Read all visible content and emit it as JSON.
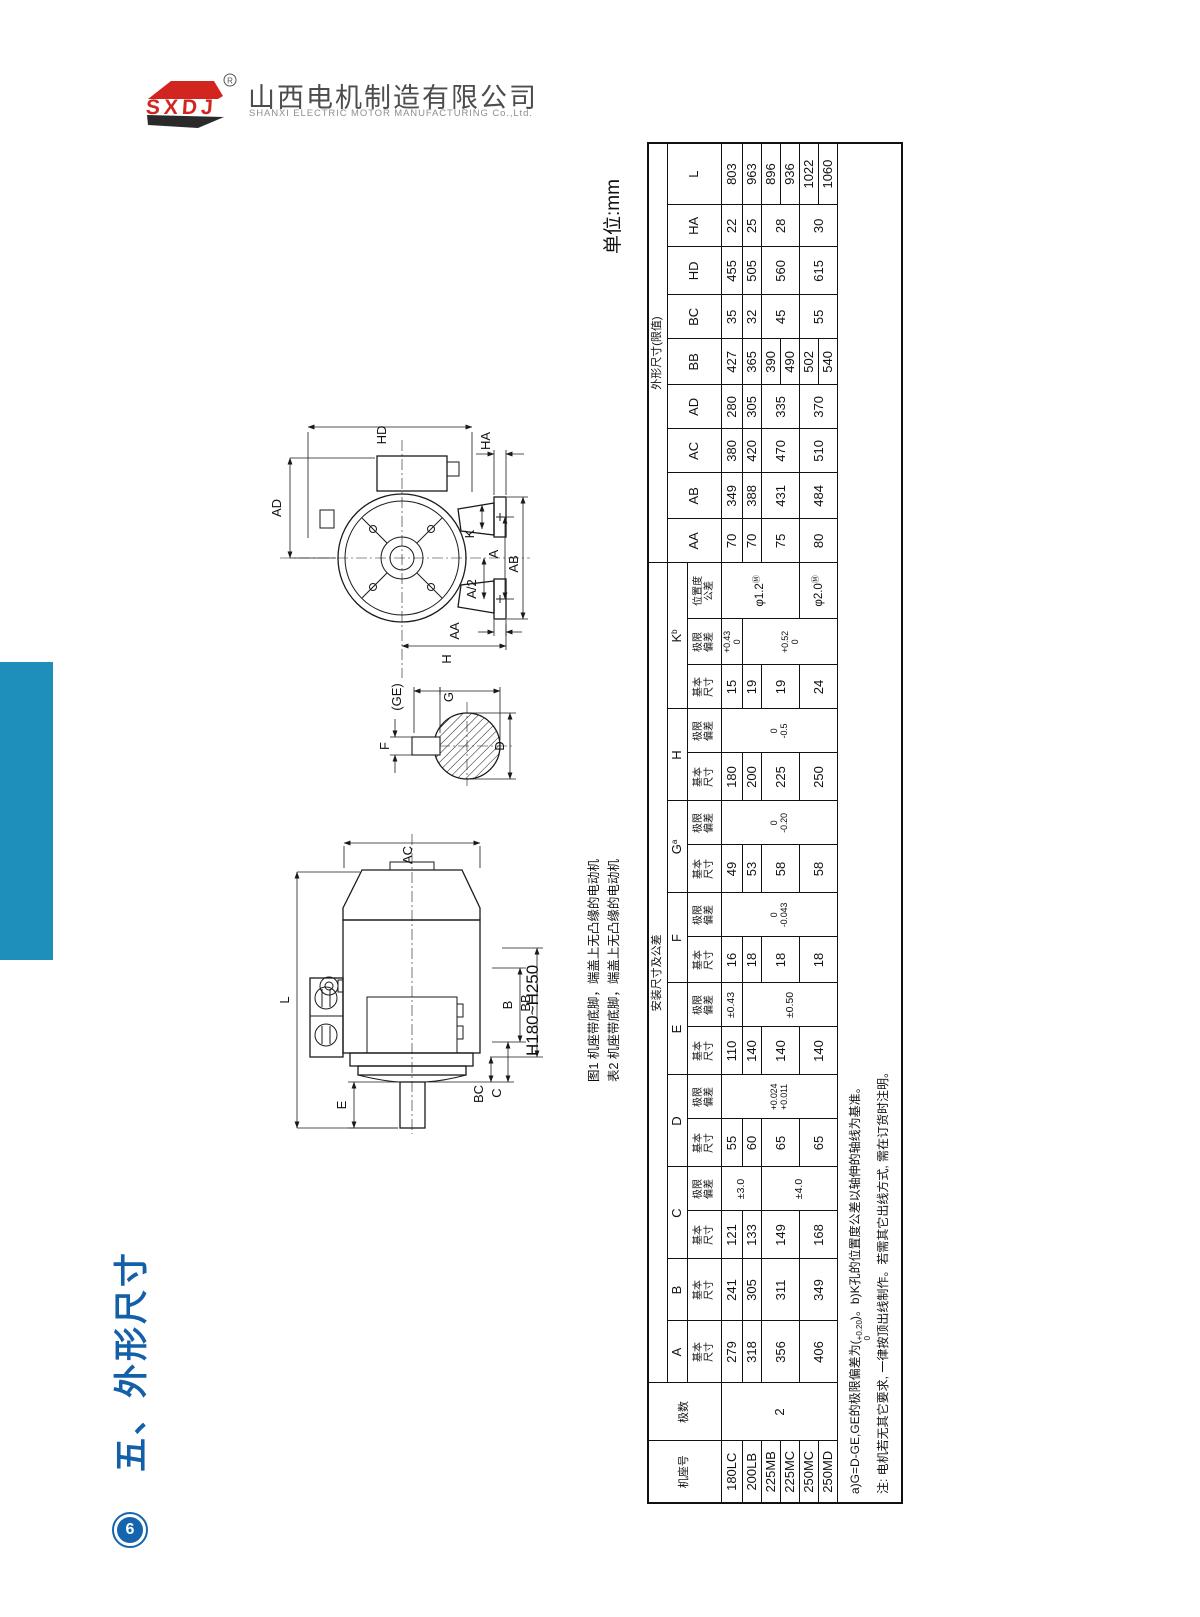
{
  "colors": {
    "bar_blue": "#1d8fba",
    "title_blue": "#135fa8",
    "logo_red": "#d3251f",
    "line_black": "#1a1a1a"
  },
  "logo": {
    "brand": "SXDJ",
    "reg_mark": "R",
    "company_cn": "山西电机制造有限公司",
    "company_en": "SHANXI ELECTRIC MOTOR MANUFACTURING Co.,Ltd."
  },
  "page": {
    "section_title": "五、外形尺寸",
    "unit_label": "单位:mm",
    "page_number": "6",
    "frame_range_label": "H180~H250",
    "caption_fig1": "图1 机座带底脚，端盖上无凸缘的电动机",
    "caption_tab2": "表2 机座带底脚，端盖上无凸缘的电动机"
  },
  "figure_end_view": {
    "labels": [
      {
        "t": "HD",
        "x": 124,
        "y": 47
      },
      {
        "t": "AD",
        "x": 19,
        "y": 120
      },
      {
        "t": "HA",
        "x": 228,
        "y": 53
      },
      {
        "t": "K",
        "x": 212,
        "y": 146
      },
      {
        "t": "A",
        "x": 236,
        "y": 166
      },
      {
        "t": "AB",
        "x": 256,
        "y": 176
      },
      {
        "t": "A/2",
        "x": 214,
        "y": 201
      },
      {
        "t": "AA",
        "x": 197,
        "y": 243
      },
      {
        "t": "H",
        "x": 189,
        "y": 271
      },
      {
        "t": "(GE)",
        "x": 139,
        "y": 309
      },
      {
        "t": "G",
        "x": 191,
        "y": 309
      },
      {
        "t": "F",
        "x": 127,
        "y": 358
      },
      {
        "t": "D",
        "x": 242,
        "y": 358
      }
    ]
  },
  "figure_side_view": {
    "labels": [
      {
        "t": "AC",
        "x": 150,
        "y": 27
      },
      {
        "t": "L",
        "x": 27,
        "y": 172
      },
      {
        "t": "B",
        "x": 250,
        "y": 177
      },
      {
        "t": "BB",
        "x": 268,
        "y": 175
      },
      {
        "t": "C",
        "x": 239,
        "y": 265
      },
      {
        "t": "BC",
        "x": 221,
        "y": 266
      },
      {
        "t": "E",
        "x": 84,
        "y": 277
      }
    ]
  },
  "table": {
    "col_widths": [
      62,
      58,
      62,
      62,
      48,
      44,
      48,
      44,
      48,
      44,
      46,
      44,
      48,
      44,
      48,
      44,
      44,
      46,
      56,
      44,
      46,
      44,
      44,
      46,
      44,
      48,
      42,
      62
    ],
    "header_rows": [
      [
        {
          "t": "机座号",
          "rs": 3,
          "cls": "grp"
        },
        {
          "t": "极数",
          "rs": 3,
          "cls": "grp"
        },
        {
          "t": "安装尺寸及公差",
          "cs": 17,
          "cls": "grp"
        },
        {
          "t": "外形尺寸(限值)",
          "cs": 9,
          "cls": "grp"
        }
      ],
      [
        {
          "t": "A"
        },
        {
          "t": "B"
        },
        {
          "t": "C",
          "cs": 2
        },
        {
          "t": "D",
          "cs": 2
        },
        {
          "t": "E",
          "cs": 2
        },
        {
          "t": "F",
          "cs": 2
        },
        {
          "t": "G",
          "sup": "a",
          "cs": 2
        },
        {
          "t": "H",
          "cs": 2
        },
        {
          "t": "K",
          "sup": "b",
          "cs": 3
        },
        {
          "t": "AA",
          "rs": 2
        },
        {
          "t": "AB",
          "rs": 2
        },
        {
          "t": "AC",
          "rs": 2
        },
        {
          "t": "AD",
          "rs": 2
        },
        {
          "t": "BB",
          "rs": 2
        },
        {
          "t": "BC",
          "rs": 2
        },
        {
          "t": "HD",
          "rs": 2
        },
        {
          "t": "HA",
          "rs": 2
        },
        {
          "t": "L",
          "rs": 2
        }
      ],
      [
        {
          "l": [
            "基本",
            "尺寸"
          ]
        },
        {
          "l": [
            "基本",
            "尺寸"
          ]
        },
        {
          "l": [
            "基本",
            "尺寸"
          ]
        },
        {
          "l": [
            "极限",
            "偏差"
          ]
        },
        {
          "l": [
            "基本",
            "尺寸"
          ]
        },
        {
          "l": [
            "极限",
            "偏差"
          ]
        },
        {
          "l": [
            "基本",
            "尺寸"
          ]
        },
        {
          "l": [
            "极限",
            "偏差"
          ]
        },
        {
          "l": [
            "基本",
            "尺寸"
          ]
        },
        {
          "l": [
            "极限",
            "偏差"
          ]
        },
        {
          "l": [
            "基本",
            "尺寸"
          ]
        },
        {
          "l": [
            "极限",
            "偏差"
          ]
        },
        {
          "l": [
            "基本",
            "尺寸"
          ]
        },
        {
          "l": [
            "极限",
            "偏差"
          ]
        },
        {
          "l": [
            "基本",
            "尺寸"
          ]
        },
        {
          "l": [
            "极限",
            "偏差"
          ]
        },
        {
          "l": [
            "位置度",
            "公差"
          ]
        }
      ]
    ],
    "body_rows": [
      [
        {
          "t": "180LC"
        },
        {
          "t": "2",
          "rs": 6
        },
        {
          "t": "279"
        },
        {
          "t": "241"
        },
        {
          "t": "121"
        },
        {
          "t": "±3.0",
          "rs": 2,
          "cls": "tol"
        },
        {
          "t": "55"
        },
        {
          "l": [
            "+0.024",
            "+0.011"
          ],
          "rs": 6,
          "cls": "dev"
        },
        {
          "t": "110"
        },
        {
          "t": "±0.43",
          "cls": "tol"
        },
        {
          "t": "16"
        },
        {
          "l": [
            "0",
            "-0.043"
          ],
          "rs": 6,
          "cls": "dev"
        },
        {
          "t": "49"
        },
        {
          "l": [
            "0",
            "-0.20"
          ],
          "rs": 6,
          "cls": "dev"
        },
        {
          "t": "180"
        },
        {
          "l": [
            "0",
            "-0.5"
          ],
          "rs": 6,
          "cls": "dev"
        },
        {
          "t": "15"
        },
        {
          "l": [
            "+0.43",
            "0"
          ],
          "cls": "dev"
        },
        {
          "t": "φ1.2",
          "sup": "Ⓜ",
          "rs": 4,
          "cls": "pos"
        },
        {
          "t": "70"
        },
        {
          "t": "349"
        },
        {
          "t": "380"
        },
        {
          "t": "280"
        },
        {
          "t": "427"
        },
        {
          "t": "35"
        },
        {
          "t": "455"
        },
        {
          "t": "22"
        },
        {
          "t": "803"
        }
      ],
      [
        {
          "t": "200LB"
        },
        {
          "t": "318"
        },
        {
          "t": "305"
        },
        {
          "t": "133"
        },
        {
          "t": "60"
        },
        {
          "t": "140"
        },
        {
          "t": "±0.50",
          "rs": 5,
          "cls": "tol"
        },
        {
          "t": "18"
        },
        {
          "t": "53"
        },
        {
          "t": "200"
        },
        {
          "t": "19"
        },
        {
          "l": [
            "+0.52",
            "0"
          ],
          "rs": 5,
          "cls": "dev"
        },
        {
          "t": "70"
        },
        {
          "t": "388"
        },
        {
          "t": "420"
        },
        {
          "t": "305"
        },
        {
          "t": "365"
        },
        {
          "t": "32"
        },
        {
          "t": "505"
        },
        {
          "t": "25"
        },
        {
          "t": "963"
        }
      ],
      [
        {
          "t": "225MB"
        },
        {
          "t": "356",
          "rs": 2
        },
        {
          "t": "311",
          "rs": 2
        },
        {
          "t": "149",
          "rs": 2
        },
        {
          "t": "±4.0",
          "rs": 4,
          "cls": "tol"
        },
        {
          "t": "65",
          "rs": 2
        },
        {
          "t": "140",
          "rs": 2
        },
        {
          "t": "18",
          "rs": 2
        },
        {
          "t": "58",
          "rs": 2
        },
        {
          "t": "225",
          "rs": 2
        },
        {
          "t": "19",
          "rs": 2
        },
        {
          "t": "75",
          "rs": 2
        },
        {
          "t": "431",
          "rs": 2
        },
        {
          "t": "470",
          "rs": 2
        },
        {
          "t": "335",
          "rs": 2
        },
        {
          "t": "390"
        },
        {
          "t": "45",
          "rs": 2
        },
        {
          "t": "560",
          "rs": 2
        },
        {
          "t": "28",
          "rs": 2
        },
        {
          "t": "896"
        }
      ],
      [
        {
          "t": "225MC"
        },
        {
          "t": "490"
        },
        {
          "t": "936"
        }
      ],
      [
        {
          "t": "250MC"
        },
        {
          "t": "406",
          "rs": 2
        },
        {
          "t": "349",
          "rs": 2
        },
        {
          "t": "168",
          "rs": 2
        },
        {
          "t": "65",
          "rs": 2
        },
        {
          "t": "140",
          "rs": 2
        },
        {
          "t": "18",
          "rs": 2
        },
        {
          "t": "58",
          "rs": 2
        },
        {
          "t": "250",
          "rs": 2
        },
        {
          "t": "24",
          "rs": 2
        },
        {
          "t": "φ2.0",
          "sup": "Ⓜ",
          "rs": 2,
          "cls": "pos"
        },
        {
          "t": "80",
          "rs": 2
        },
        {
          "t": "484",
          "rs": 2
        },
        {
          "t": "510",
          "rs": 2
        },
        {
          "t": "370",
          "rs": 2
        },
        {
          "t": "502"
        },
        {
          "t": "55",
          "rs": 2
        },
        {
          "t": "615",
          "rs": 2
        },
        {
          "t": "30",
          "rs": 2
        },
        {
          "t": "1022"
        }
      ],
      [
        {
          "t": "250MD"
        },
        {
          "t": "540"
        },
        {
          "t": "1060"
        }
      ]
    ],
    "notes": {
      "n1_pre": "a)G=D-GE,GE的极限偏差为(",
      "n1_sup": "+0.20",
      "n1_sub": "0",
      "n1_post": ")。b)K孔的位置度公差以轴伸的轴线为基准。",
      "n2": "注: 电机若无其它要求, 一律按顶出线制作。若需其它出线方式, 需在订货时注明。"
    }
  }
}
